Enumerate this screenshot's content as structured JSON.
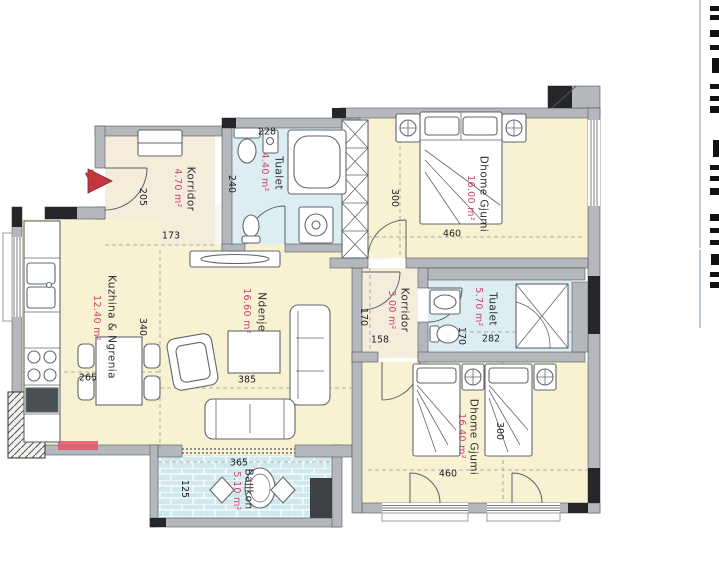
{
  "unit": {
    "number": "24"
  },
  "rooms": {
    "korridor1": {
      "name": "Korridor",
      "area": "4.70 m²"
    },
    "tualet1": {
      "name": "Tualet",
      "area": "4.40 m²"
    },
    "bedroom1": {
      "name": "Dhome Gjumi",
      "area": "16.00 m²"
    },
    "korridor2": {
      "name": "Korridor",
      "area": "3.00 m²"
    },
    "tualet2": {
      "name": "Tualet",
      "area": "5.70 m²"
    },
    "bedroom2": {
      "name": "Dhome Gjumi",
      "area": "16.40 m²"
    },
    "kitchen": {
      "name": "Kuzhina & Ngrenia",
      "area": "12.40 m²"
    },
    "living": {
      "name": "Ndenje",
      "area": "16.60 m²"
    },
    "balcony": {
      "name": "Ballkon",
      "area": "5.10 m²"
    }
  },
  "dimensions_cm": {
    "entry_wall": "205",
    "korridor1_width": "173",
    "tualet1_width": "228",
    "tualet1_height": "240",
    "bedroom1_height": "300",
    "bedroom1_width": "460",
    "kitchen_height": "340",
    "kitchen_width": "265",
    "living_width": "385",
    "korridor2_height": "170",
    "korridor2_width": "158",
    "tualet2_height": "170",
    "tualet2_width": "282",
    "bedroom2_height": "300",
    "bedroom2_width": "460",
    "balcony_width": "365",
    "balcony_height": "125"
  },
  "colors": {
    "room_fill": "#f8f1d2",
    "corridor_fill": "#f6ecdc",
    "wet_room_fill": "#dcedf4",
    "balcony_tile": "#cfe9ee",
    "wall": "#b4b7bb",
    "structure_black": "#26262a",
    "area_text": "#c84468",
    "entry_marker": "#c1393f"
  }
}
